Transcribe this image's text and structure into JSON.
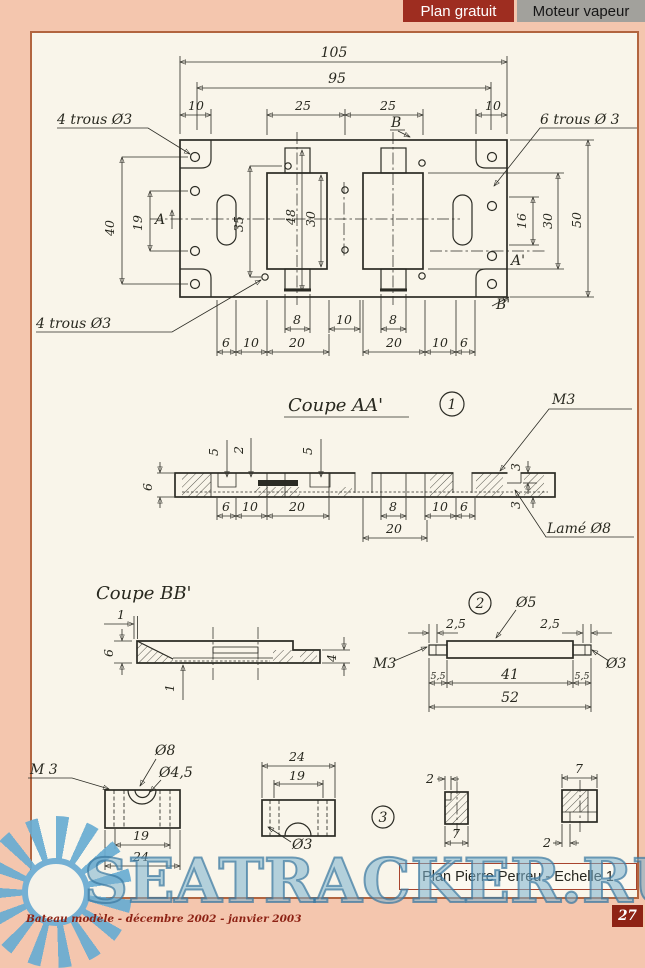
{
  "header": {
    "plan_label": "Plan gratuit",
    "subject_label": "Moteur vapeur"
  },
  "watermark": {
    "text": "SEATRACKER.RU"
  },
  "footer": {
    "credit": "Plan Pierre Perreu - Echelle 1",
    "magazine": "Bateau modèle - décembre 2002 - janvier 2003",
    "page": "27"
  },
  "drawing": {
    "t105": "105",
    "t95": "95",
    "t10l": "10",
    "t25a": "25",
    "t25b": "25",
    "t10r": "10",
    "trous4a": "4 trous Ø3",
    "trous4b": "4 trous Ø3",
    "trous6": "6 trous Ø 3",
    "t40": "40",
    "t19": "19",
    "tA": "A",
    "tAp": "A'",
    "tB": "B",
    "tBp": "B'",
    "t35": "35",
    "t48": "48",
    "t30a": "30",
    "t16": "16",
    "t30b": "30",
    "t50": "50",
    "t8a": "8",
    "t10m": "10",
    "t8b": "8",
    "t6bl": "6",
    "t10bl": "10",
    "t20bl": "20",
    "t20br": "20",
    "t10br": "10",
    "t6br": "6",
    "aa_title": "Coupe AA'",
    "aa_num": "1",
    "aa_m3": "M3",
    "aa_lame": "Lamé Ø8",
    "aa5a": "5",
    "aa2": "2",
    "aa5b": "5",
    "aa6": "6",
    "aa3t": "3",
    "aa3b": "3",
    "aab6a": "6",
    "aab10a": "10",
    "aab20a": "20",
    "aab8": "8",
    "aab10b": "10",
    "aab6b": "6",
    "aab20b": "20",
    "bb_title": "Coupe BB'",
    "bb1t": "1",
    "bb6": "6",
    "bb4": "4",
    "bb1b": "1",
    "p2num": "2",
    "p2o5": "Ø5",
    "p2m3": "M3",
    "p2o3": "Ø3",
    "p2c25a": "2,5",
    "p2c25b": "2,5",
    "p2c55a": "5,5",
    "p2t41": "41",
    "p2c55b": "5,5",
    "p2t52": "52",
    "p3num": "3",
    "b1m3": "M 3",
    "b1o8": "Ø8",
    "b1o45": "Ø4,5",
    "b1t19": "19",
    "b1t24": "24",
    "b2t24": "24",
    "b2t19": "19",
    "b2o3": "Ø3",
    "sl2": "2",
    "sl7": "7",
    "sr7": "7",
    "sr2": "2"
  }
}
